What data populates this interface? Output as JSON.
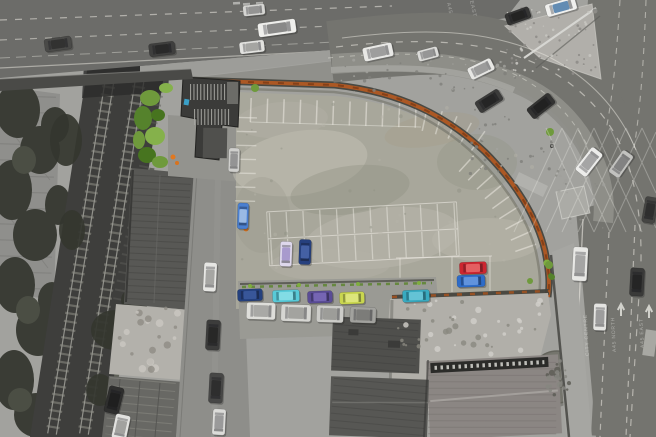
{
  "meta": {
    "description": "Aerial drone photograph of an urban pay-and-display car park bounded by a rust-coloured retaining wall, beside a railway line, warehouses and a curving road junction",
    "style": "selective colour: scene desaturated except the car park surface, vegetation and parked cars"
  },
  "palette": {
    "tarmac": "#6c6c69",
    "curve_road": "#74746f",
    "car_park": "#a8a79b",
    "rust_wall": "#b25a23",
    "railway": "#3e3e3c",
    "vegetation": "#6f9a3c",
    "marking_white": "#eceae2"
  },
  "road_text": {
    "top_lane_a": "A45",
    "top_lane_b": "EAST",
    "right_lane_1": "CITY CENTRE",
    "right_lane_2": "A45 NORTH",
    "right_lane_3": "A45 EAST"
  },
  "features": [
    "dual-carriageway",
    "curved-junction",
    "box-junction-hatching",
    "traffic-island",
    "car-park",
    "rust-retaining-wall",
    "pedestrian-staircase",
    "railway-tracks",
    "warehouse-roofs",
    "street-parking",
    "trees"
  ],
  "vehicles": {
    "moving_gray": [
      {
        "name": "car-dark",
        "x": 58,
        "y": 44,
        "w": 27,
        "h": 13,
        "rot": -8,
        "body": "#4a4a48",
        "glass": "#2e2e2e"
      },
      {
        "name": "car-dark",
        "x": 162,
        "y": 49,
        "w": 26,
        "h": 13,
        "rot": -7,
        "body": "#3f3f3e",
        "glass": "#262626"
      },
      {
        "name": "car-white",
        "x": 252,
        "y": 47,
        "w": 25,
        "h": 12,
        "rot": -7,
        "body": "#e2e2df",
        "glass": "#9a9a98"
      },
      {
        "name": "pickup-white",
        "x": 277,
        "y": 28,
        "w": 38,
        "h": 14,
        "rot": -8,
        "body": "#efefec",
        "glass": "#777777"
      },
      {
        "name": "car-white",
        "x": 254,
        "y": 10,
        "w": 22,
        "h": 11,
        "rot": -6,
        "body": "#d5d5d2",
        "glass": "#888888"
      },
      {
        "name": "car-white",
        "x": 378,
        "y": 52,
        "w": 30,
        "h": 14,
        "rot": -12,
        "body": "#e8e8e5",
        "glass": "#909090"
      },
      {
        "name": "car-white",
        "x": 428,
        "y": 54,
        "w": 21,
        "h": 11,
        "rot": -15,
        "body": "#dcdcd9",
        "glass": "#8a8a8a"
      },
      {
        "name": "car-white",
        "x": 481,
        "y": 69,
        "w": 26,
        "h": 13,
        "rot": -26,
        "body": "#e6e6e3",
        "glass": "#8e8e8e"
      },
      {
        "name": "car-dark",
        "x": 489,
        "y": 101,
        "w": 27,
        "h": 13,
        "rot": -32,
        "body": "#3b3b3a",
        "glass": "#222222"
      },
      {
        "name": "car-dark",
        "x": 541,
        "y": 106,
        "w": 28,
        "h": 13,
        "rot": -38,
        "body": "#333332",
        "glass": "#1e1e1e"
      },
      {
        "name": "car-white",
        "x": 589,
        "y": 162,
        "w": 29,
        "h": 14,
        "rot": -52,
        "body": "#ececea",
        "glass": "#999999"
      },
      {
        "name": "car-silver",
        "x": 621,
        "y": 164,
        "w": 27,
        "h": 13,
        "rot": -55,
        "body": "#c2c2bf",
        "glass": "#777777"
      },
      {
        "name": "car-dark",
        "x": 518,
        "y": 16,
        "w": 25,
        "h": 12,
        "rot": -20,
        "body": "#353534",
        "glass": "#202020"
      },
      {
        "name": "van-white",
        "x": 561,
        "y": 7,
        "w": 31,
        "h": 13,
        "rot": -16,
        "body": "#f0f0ee",
        "glass": "#4a7aa8"
      },
      {
        "name": "van-white",
        "x": 580,
        "y": 264,
        "w": 15,
        "h": 34,
        "rot": 3,
        "body": "#e8e8e5",
        "glass": "#999999"
      },
      {
        "name": "car-white",
        "x": 600,
        "y": 317,
        "w": 13,
        "h": 27,
        "rot": 2,
        "body": "#e4e4e1",
        "glass": "#909090"
      },
      {
        "name": "car-dark",
        "x": 637,
        "y": 282,
        "w": 14,
        "h": 28,
        "rot": 3,
        "body": "#3a3a39",
        "glass": "#222222"
      },
      {
        "name": "car-dark",
        "x": 650,
        "y": 210,
        "w": 13,
        "h": 26,
        "rot": 10,
        "body": "#454543",
        "glass": "#2a2a2a"
      }
    ],
    "parked_gray": [
      {
        "name": "car-white",
        "x": 210,
        "y": 277,
        "w": 13,
        "h": 29,
        "rot": 3,
        "body": "#e6e6e3",
        "glass": "#9a9a98"
      },
      {
        "name": "car-dark",
        "x": 213,
        "y": 335,
        "w": 14,
        "h": 30,
        "rot": 3,
        "body": "#3c3c3b",
        "glass": "#242424"
      },
      {
        "name": "car-dark",
        "x": 216,
        "y": 388,
        "w": 14,
        "h": 30,
        "rot": 3,
        "body": "#474746",
        "glass": "#2a2a2a"
      },
      {
        "name": "car-white",
        "x": 219,
        "y": 422,
        "w": 13,
        "h": 26,
        "rot": 3,
        "body": "#dcdcd9",
        "glass": "#8e8e8e"
      },
      {
        "name": "car-silver",
        "x": 234,
        "y": 160,
        "w": 11,
        "h": 24,
        "rot": 2,
        "body": "#cfcfcc",
        "glass": "#8a8a8a"
      },
      {
        "name": "car-dark",
        "x": 114,
        "y": 400,
        "w": 15,
        "h": 27,
        "rot": 14,
        "body": "#2f2f2e",
        "glass": "#1c1c1c"
      },
      {
        "name": "car-white",
        "x": 121,
        "y": 427,
        "w": 15,
        "h": 25,
        "rot": 12,
        "body": "#e2e2df",
        "glass": "#969694"
      },
      {
        "name": "van-white",
        "x": 261,
        "y": 311,
        "w": 29,
        "h": 17,
        "rot": 2,
        "body": "#dededa",
        "glass": "#a0a09c"
      },
      {
        "name": "van-white",
        "x": 296,
        "y": 313,
        "w": 30,
        "h": 17,
        "rot": 2,
        "body": "#d6d6d2",
        "glass": "#9a9a96"
      },
      {
        "name": "van-white",
        "x": 330,
        "y": 314,
        "w": 27,
        "h": 17,
        "rot": 2,
        "body": "#ccccc8",
        "glass": "#949490"
      },
      {
        "name": "truck-gray",
        "x": 363,
        "y": 315,
        "w": 26,
        "h": 16,
        "rot": 2,
        "body": "#a2a29e",
        "glass": "#767672"
      }
    ],
    "parked_colored": [
      {
        "name": "car-blue",
        "x": 243,
        "y": 216,
        "w": 11,
        "h": 26,
        "rot": 2,
        "body": "#4a7fd0",
        "glass": "#a8c4e8"
      },
      {
        "name": "car-white-violet",
        "x": 286,
        "y": 254,
        "w": 12,
        "h": 25,
        "rot": 2,
        "body": "#ded8ec",
        "glass": "#9f8fc8"
      },
      {
        "name": "car-navy",
        "x": 305,
        "y": 252,
        "w": 12,
        "h": 25,
        "rot": 2,
        "body": "#26407e",
        "glass": "#4a66aa"
      },
      {
        "name": "car-navy",
        "x": 250,
        "y": 295,
        "w": 25,
        "h": 12,
        "rot": -2,
        "body": "#24407e",
        "glass": "#3c5a9e"
      },
      {
        "name": "car-cyan",
        "x": 286,
        "y": 296,
        "w": 27,
        "h": 12,
        "rot": -2,
        "body": "#58cad8",
        "glass": "#8adfe8"
      },
      {
        "name": "car-purple",
        "x": 320,
        "y": 297,
        "w": 25,
        "h": 12,
        "rot": -2,
        "body": "#5a4c96",
        "glass": "#7a6ab8"
      },
      {
        "name": "car-yellow",
        "x": 352,
        "y": 298,
        "w": 25,
        "h": 12,
        "rot": -2,
        "body": "#c9d64f",
        "glass": "#e0e882"
      },
      {
        "name": "car-teal",
        "x": 416,
        "y": 296,
        "w": 27,
        "h": 12,
        "rot": -2,
        "body": "#38aac0",
        "glass": "#6cc8d8"
      },
      {
        "name": "car-red",
        "x": 473,
        "y": 268,
        "w": 27,
        "h": 12,
        "rot": -2,
        "body": "#cc2630",
        "glass": "#e86a6a"
      },
      {
        "name": "car-blue",
        "x": 471,
        "y": 281,
        "w": 28,
        "h": 12,
        "rot": -2,
        "body": "#2e6cc8",
        "glass": "#6a9ae0"
      }
    ]
  }
}
